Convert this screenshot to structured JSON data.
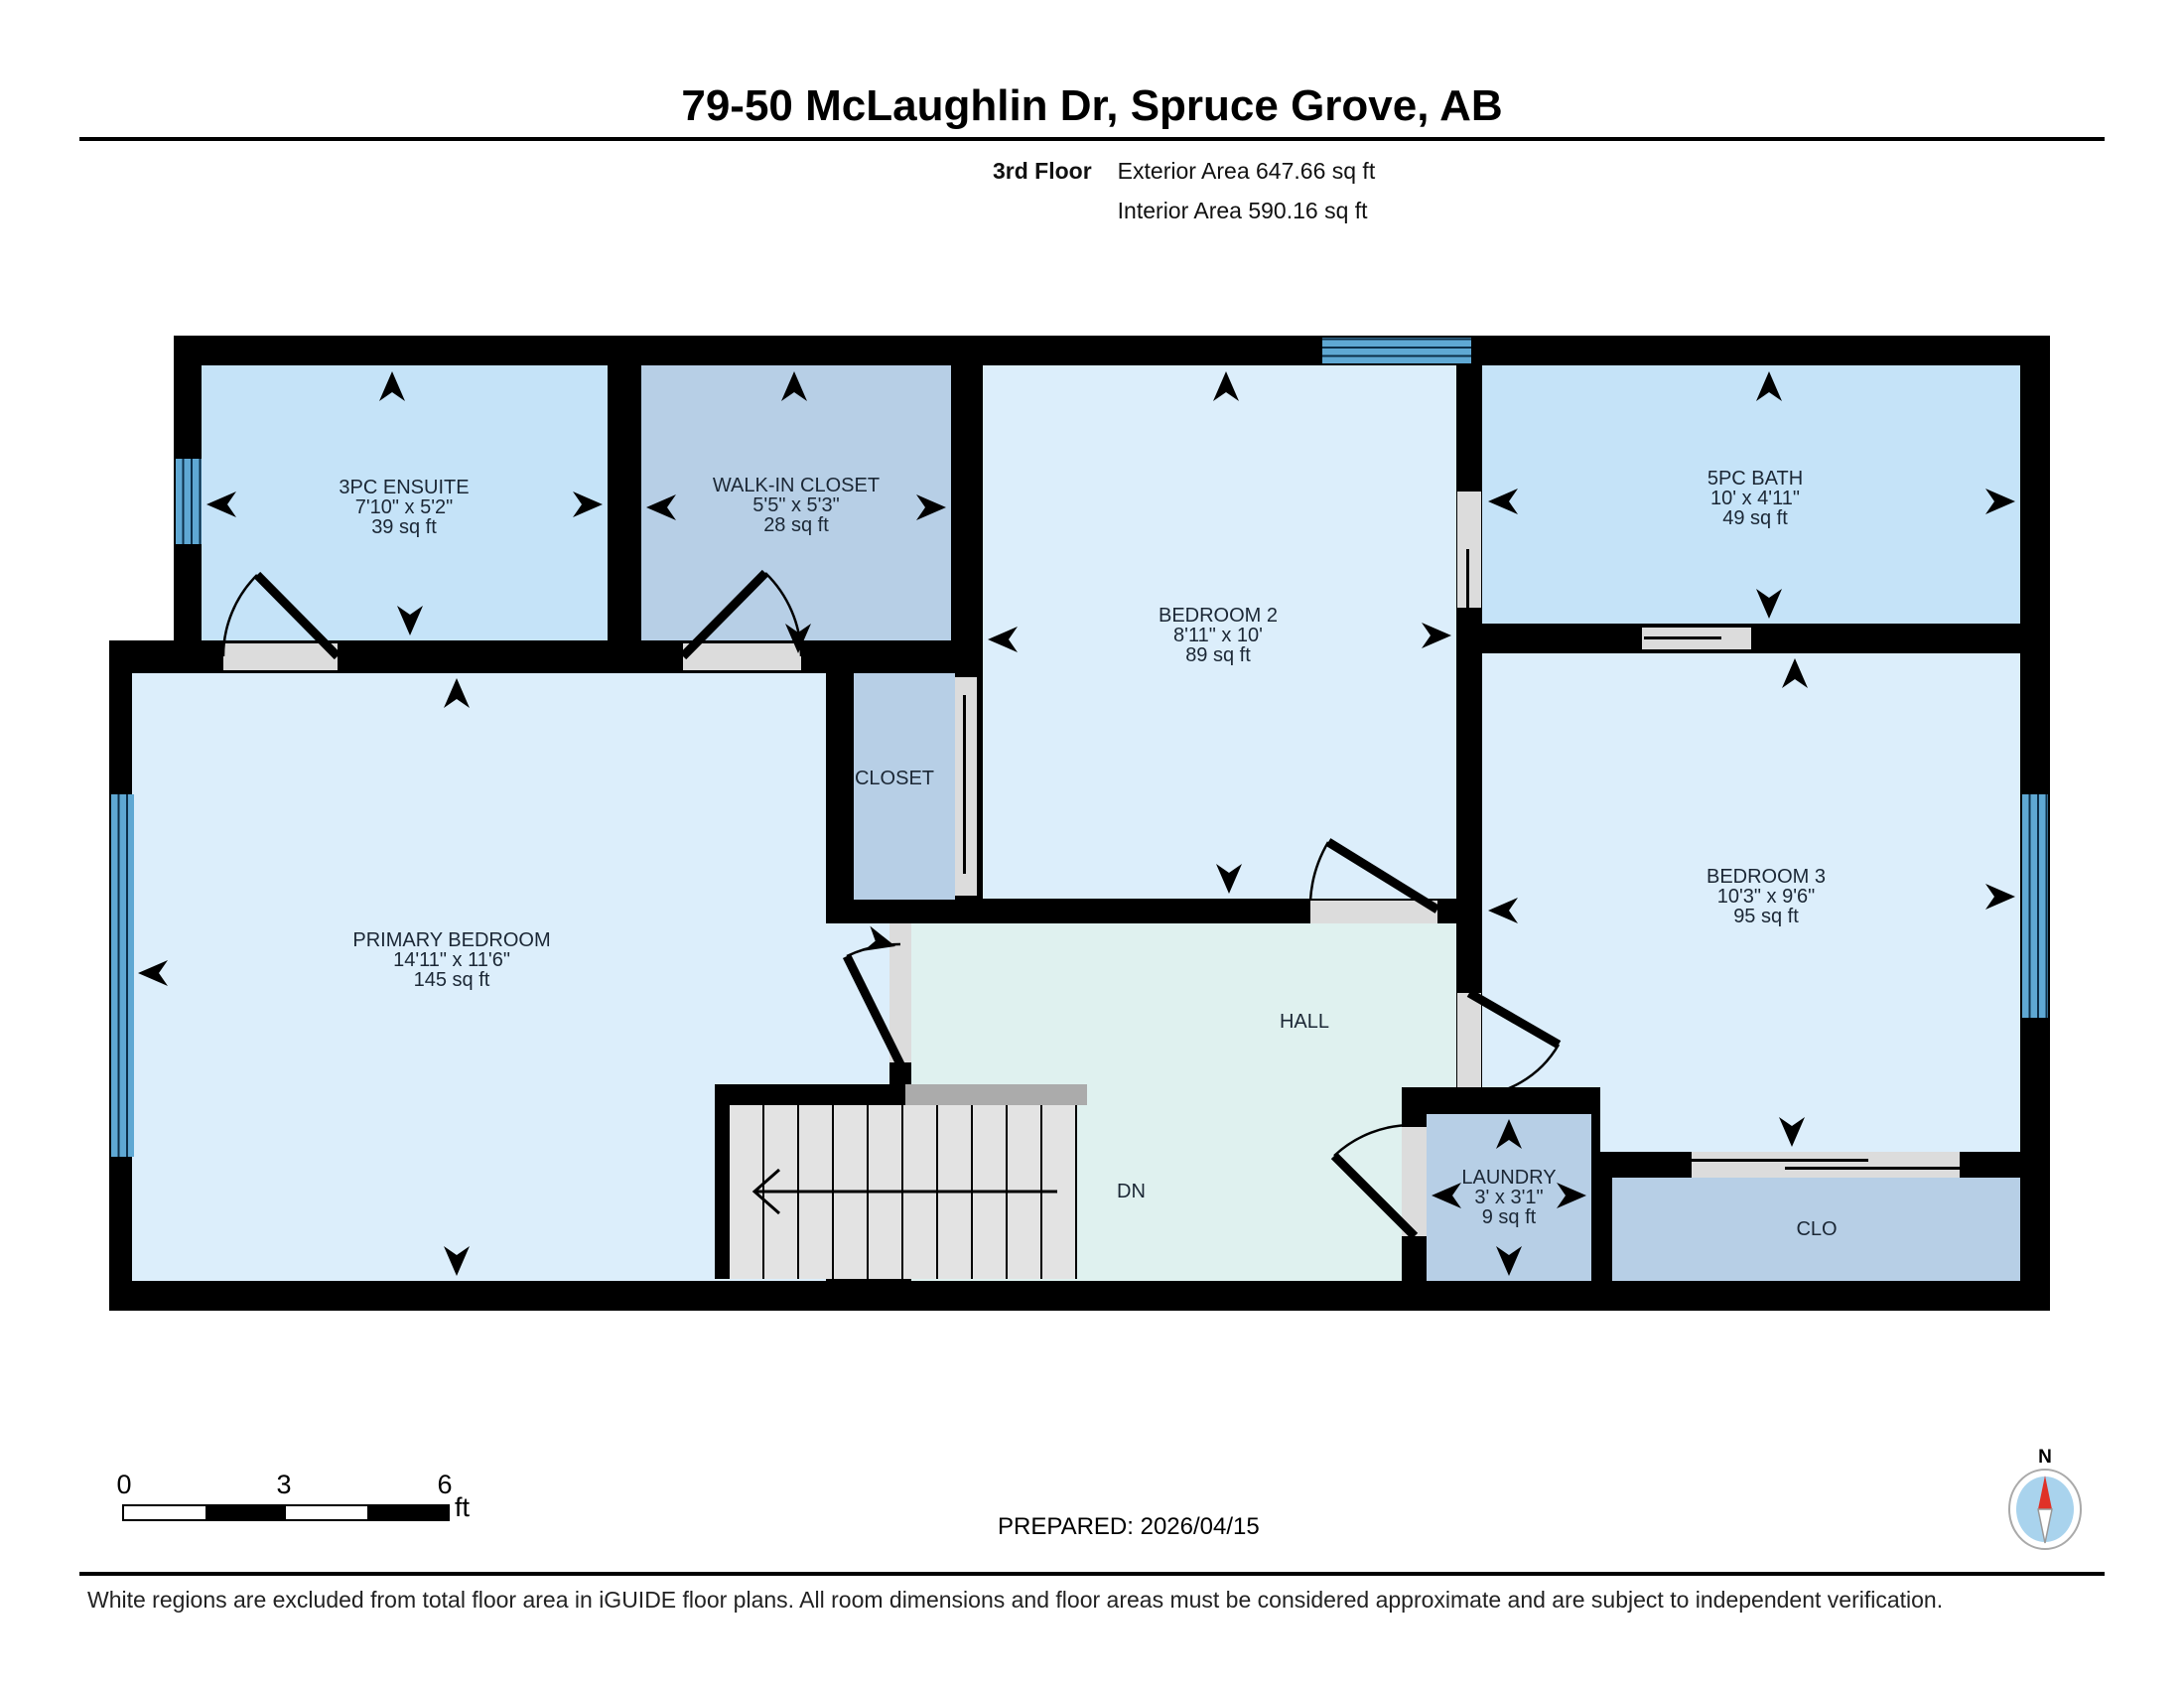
{
  "header": {
    "title": "79-50 McLaughlin Dr, Spruce Grove, AB",
    "floor_label": "3rd Floor",
    "exterior_area": "Exterior Area 647.66 sq ft",
    "interior_area": "Interior Area 590.16 sq ft"
  },
  "rooms": {
    "ensuite": {
      "name": "3PC ENSUITE",
      "dims": "7'10\" x 5'2\"",
      "area": "39 sq ft"
    },
    "walkin": {
      "name": "WALK-IN CLOSET",
      "dims": "5'5\" x 5'3\"",
      "area": "28 sq ft"
    },
    "bedroom2": {
      "name": "BEDROOM 2",
      "dims": "8'11\" x 10'",
      "area": "89 sq ft"
    },
    "bath": {
      "name": "5PC BATH",
      "dims": "10' x 4'11\"",
      "area": "49 sq ft"
    },
    "primary": {
      "name": "PRIMARY BEDROOM",
      "dims": "14'11\" x 11'6\"",
      "area": "145 sq ft"
    },
    "bedroom3": {
      "name": "BEDROOM 3",
      "dims": "10'3\" x 9'6\"",
      "area": "95 sq ft"
    },
    "closet": {
      "name": "CLOSET"
    },
    "hall": {
      "name": "HALL"
    },
    "laundry": {
      "name": "LAUNDRY",
      "dims": "3' x 3'1\"",
      "area": "9 sq ft"
    },
    "clo": {
      "name": "CLO"
    }
  },
  "stairs": {
    "label": "DN"
  },
  "scale_bar": {
    "tick0": "0",
    "tick1": "3",
    "tick2": "6",
    "unit": "ft"
  },
  "footer": {
    "prepared": "PREPARED: 2026/04/15",
    "disclaimer": "White regions are excluded from total floor area in iGUIDE floor plans. All room dimensions and floor areas must be considered approximate and are subject to independent verification.",
    "compass_label": "N"
  },
  "colors": {
    "wall": "#000000",
    "bath-fill": "#c5e3f8",
    "closet-fill": "#b7cfe6",
    "bedroom-fill": "#dceefb",
    "hall-fill": "#dff1ef",
    "stairs-fill": "#e3e3e3",
    "railing": "#ababab",
    "door-gap": "#dcdcdc",
    "window-blue": "#5fa8d3",
    "label": "#1b2735"
  }
}
